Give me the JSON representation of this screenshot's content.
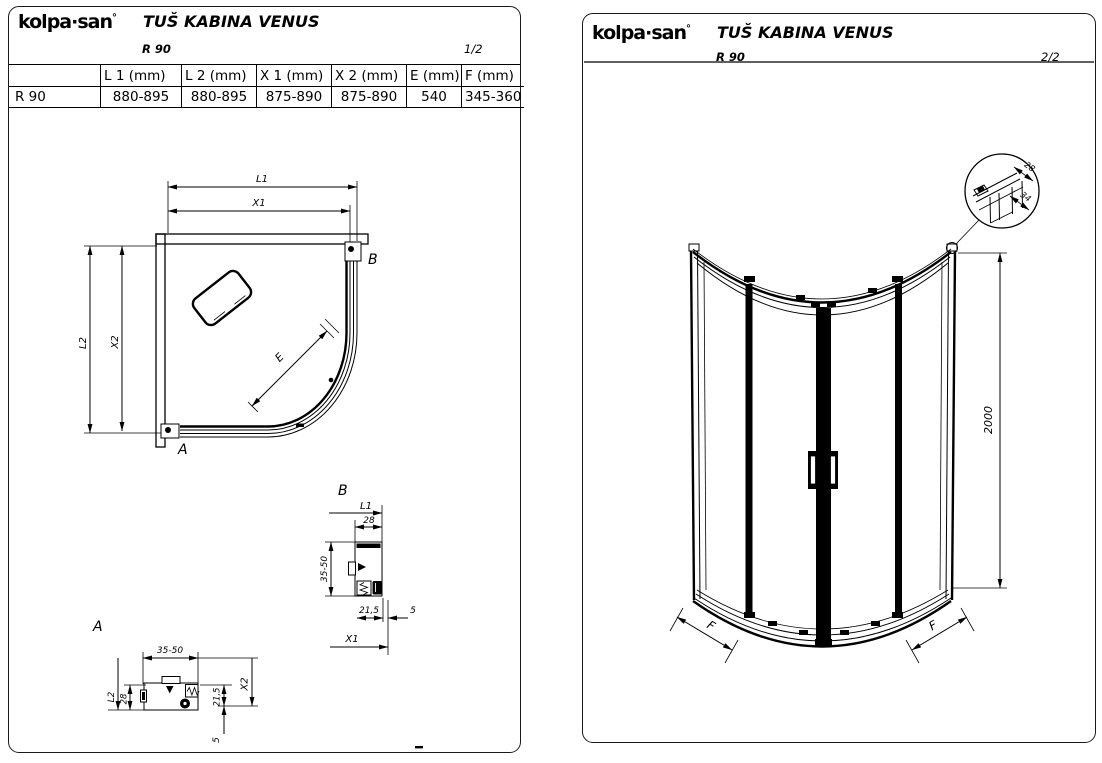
{
  "brand": {
    "logo": "kolpa·san",
    "logo_mark": "°"
  },
  "left_page": {
    "title": "TUŠ KABINA VENUS",
    "model": "R 90",
    "page_num": "1/2",
    "table": {
      "headers": [
        "",
        "L 1 (mm)",
        "L 2 (mm)",
        "X 1 (mm)",
        "X 2 (mm)",
        "E (mm)",
        "F (mm)"
      ],
      "row": [
        "R 90",
        "880-895",
        "880-895",
        "875-890",
        "875-890",
        "540",
        "345-360"
      ]
    },
    "plan": {
      "l1": "L1",
      "x1": "X1",
      "l2": "L2",
      "x2": "X2",
      "e": "E",
      "a": "A",
      "b": "B"
    },
    "detail_b": {
      "title": "B",
      "l1": "L1",
      "d28": "28",
      "d3550": "35-50",
      "d215": "21,5",
      "d5": "5",
      "x1": "X1"
    },
    "detail_a": {
      "title": "A",
      "d3550": "35-50",
      "l2": "L2",
      "d28": "28",
      "x2": "X2",
      "d215": "21,5",
      "d5": "5"
    }
  },
  "right_page": {
    "title": "TUŠ KABINA VENUS",
    "model": "R 90",
    "page_num": "2/2",
    "elevation": {
      "height": "2000",
      "f_left": "F",
      "f_right": "F"
    },
    "balloon": {
      "d28": "28",
      "d34": "34"
    }
  }
}
